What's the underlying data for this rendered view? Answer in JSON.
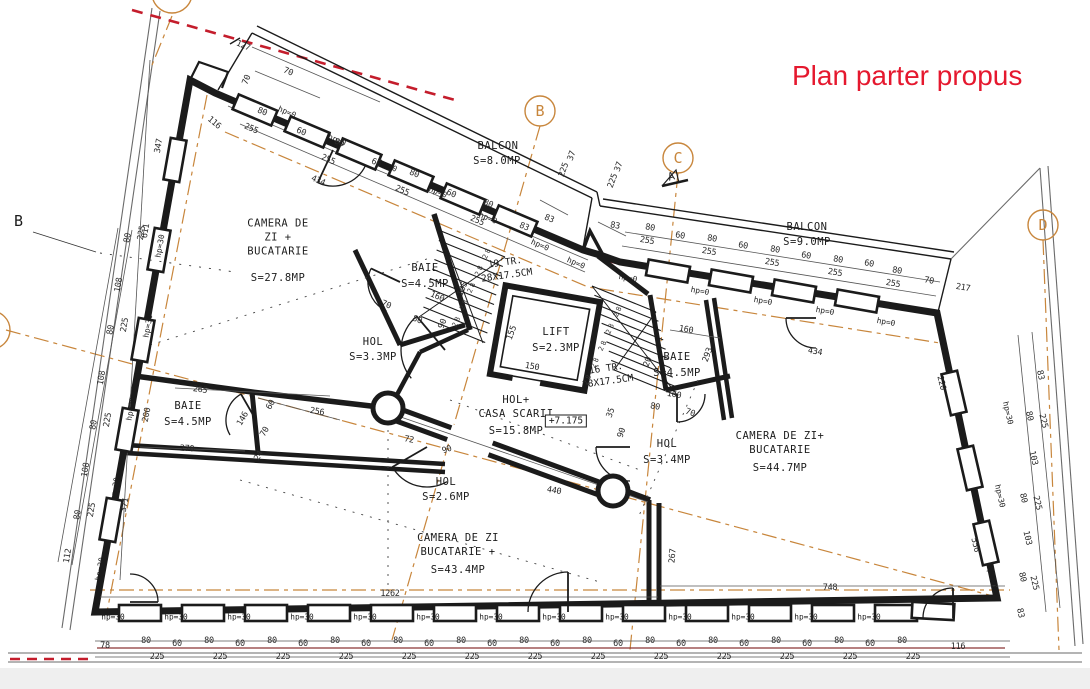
{
  "title": "Plan parter propus",
  "colors": {
    "title_red": "#e5182e",
    "axis_orange": "#c8863c",
    "line_black": "#1b1b1b",
    "demolish_red": "#c41d2c"
  },
  "rooms": {
    "camera_tl": {
      "name": "CAMERA DE\nZI +\nBUCATARIE",
      "area": "S=27.8MP"
    },
    "baie_tl": {
      "name": "BAIE",
      "area": "S=4.5MP"
    },
    "hol_tl": {
      "name": "HOL",
      "area": "S=3.3MP"
    },
    "baie_left": {
      "name": "BAIE",
      "area": "S=4.5MP"
    },
    "hol_center": {
      "name": "HOL",
      "area": "S=2.6MP"
    },
    "camera_bottom": {
      "name": "CAMERA DE ZI\nBUCATARIE +",
      "area": "S=43.4MP"
    },
    "lift": {
      "name": "LIFT",
      "area": "S=2.3MP"
    },
    "casa_scarii": {
      "name": "HOL+\nCASA SCARII",
      "area": "S=15.8MP"
    },
    "baie_right": {
      "name": "BAIE",
      "area": "S=4.5MP"
    },
    "hol_right": {
      "name": "HOL",
      "area": "S=3.4MP"
    },
    "camera_right": {
      "name": "CAMERA DE ZI+\nBUCATARIE",
      "area": "S=44.7MP"
    },
    "balcon_left": {
      "name": "BALCON",
      "area": "S=8.0MP"
    },
    "balcon_right": {
      "name": "BALCON",
      "area": "S=9.0MP"
    }
  },
  "stairs": {
    "flight_up": "19 TR.\n28X17.5CM",
    "flight_down": "16 TR.\n28X17.5CM",
    "tread_marks": "28 28 28 28 28"
  },
  "level_marker": "+7.175",
  "grid_markers": {
    "top_b": "B",
    "top_c": "C",
    "right_d": "D",
    "left_b": "B",
    "section_a": "A"
  },
  "window_labels": {
    "sill0": "hp=0",
    "sill30": "hp=30"
  },
  "dim_labels": [
    "127",
    "70",
    "70",
    "116",
    "347",
    "80",
    "255",
    "60",
    "80",
    "255",
    "60",
    "80",
    "255",
    "60",
    "80",
    "255",
    "83",
    "434",
    "611",
    "37",
    "225",
    "37",
    "225",
    "83",
    "83",
    "80",
    "255",
    "60",
    "80",
    "255",
    "60",
    "80",
    "255",
    "60",
    "80",
    "255",
    "60",
    "80",
    "255",
    "70",
    "217",
    "434",
    "220",
    "83",
    "80",
    "225",
    "103",
    "80",
    "225",
    "103",
    "80",
    "225",
    "83",
    "556",
    "78",
    "116",
    "1262",
    "748",
    "267",
    "80",
    "225",
    "108",
    "80",
    "225",
    "108",
    "80",
    "225",
    "108",
    "80",
    "225",
    "112",
    "371",
    "200",
    "265",
    "270",
    "146",
    "60",
    "70",
    "24",
    "256",
    "90",
    "72",
    "90",
    "440",
    "160",
    "70",
    "80",
    "105",
    "155",
    "150",
    "160",
    "293",
    "160",
    "80",
    "70",
    "90",
    "35",
    "20",
    "80",
    "80",
    "80",
    "80",
    "80",
    "80",
    "80",
    "80",
    "80",
    "80",
    "80",
    "80",
    "80",
    "60",
    "60",
    "60",
    "60",
    "60",
    "60",
    "60",
    "60",
    "60",
    "60",
    "60",
    "60",
    "225",
    "225",
    "225",
    "225",
    "225",
    "225",
    "225",
    "225",
    "225",
    "225",
    "225",
    "225",
    "225"
  ]
}
